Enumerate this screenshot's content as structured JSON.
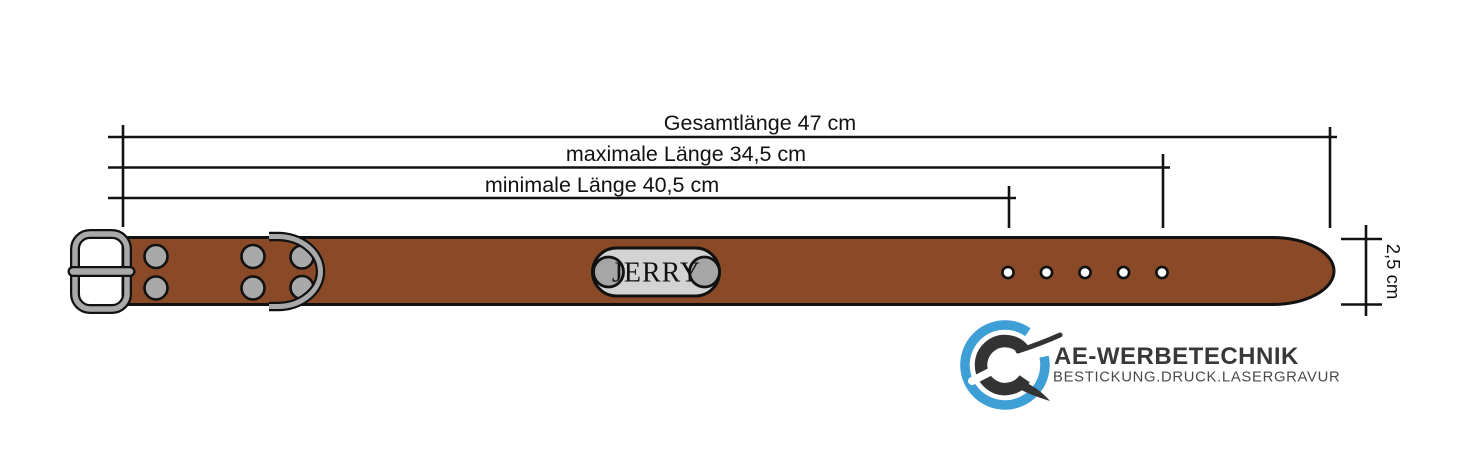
{
  "page": {
    "background": "#ffffff"
  },
  "dimensions": {
    "total_label": "Gesamtlänge 47 cm",
    "max_label": "maximale Länge 34,5 cm",
    "min_label": "minimale Länge 40,5 cm",
    "width_label": "2,5 cm"
  },
  "collar": {
    "name_tag": "JERRY",
    "holes": 5,
    "colors": {
      "leather": "#8A4A28",
      "metal": "#A9A9A9",
      "plate": "#D3D3D3",
      "screw": "#A6A6A6",
      "outline": "#111111"
    }
  },
  "brand": {
    "name": "AE-WERBETECHNIK",
    "tagline": "BESTICKUNG.DRUCK.LASERGRAVUR",
    "colors": {
      "blue": "#3E9ED6",
      "dark": "#333333"
    }
  }
}
